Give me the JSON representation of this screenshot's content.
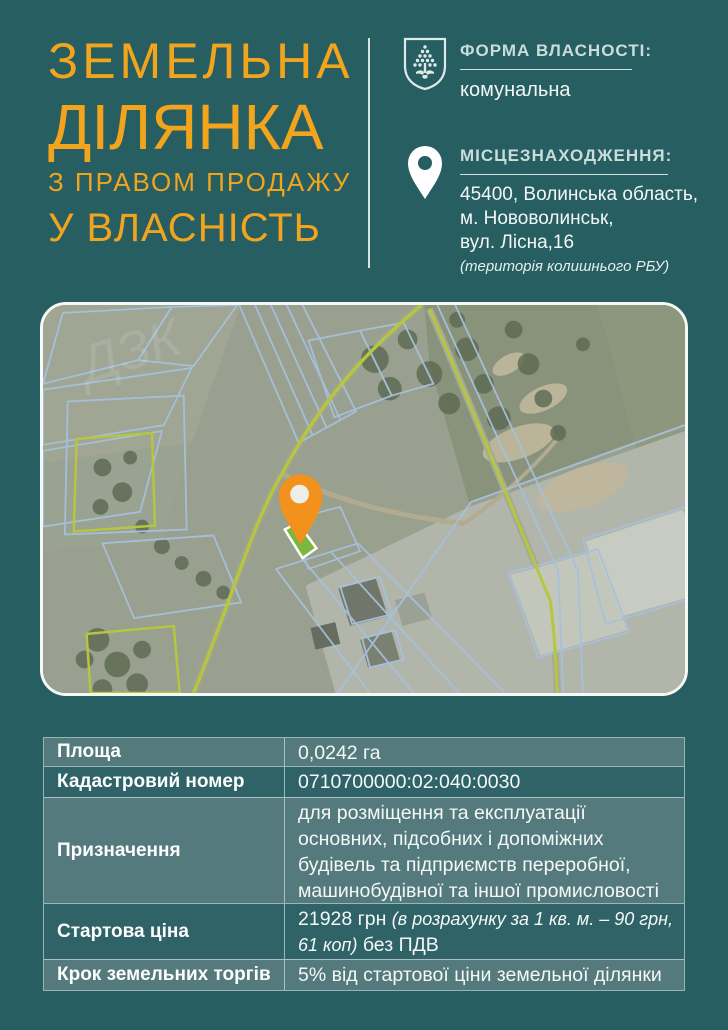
{
  "page": {
    "background_color": "#265e62",
    "accent_color": "#f2a41d"
  },
  "title": {
    "line1": "ЗЕМЕЛЬНА",
    "line2": "ДІЛЯНКА",
    "line3": "З ПРАВОМ ПРОДАЖУ",
    "line4": "У ВЛАСНІСТЬ"
  },
  "ownership": {
    "heading": "ФОРМА ВЛАСНОСТІ:",
    "value": "комунальна",
    "icon": "coat-of-arms-shield-fir-tree"
  },
  "location": {
    "heading": "МІСЦЕЗНАХОДЖЕННЯ:",
    "icon": "map-pin",
    "lines": [
      "45400, Волинська область,",
      "м. Нововолинськ,",
      "вул. Лісна,16"
    ],
    "note": "(територія колишнього РБУ)"
  },
  "map": {
    "watermark": "ДЗК",
    "pin_color": "#f2921c",
    "plot_highlight_color": "#7cb63f",
    "cadastral_line_color": "#a6c1dd",
    "road_line_color": "#b7c63e"
  },
  "table": {
    "rows": [
      {
        "label": "Площа",
        "value": [
          {
            "t": "0,0242 га"
          }
        ]
      },
      {
        "label": "Кадастровий номер",
        "value": [
          {
            "t": "0710700000:02:040:0030"
          }
        ]
      },
      {
        "label": "Призначення",
        "value": [
          {
            "t": "для розміщення та експлуатації основних, підсобних і допоміжних будівель та підприємств переробної, машинобудівної та іншої промисловості"
          }
        ]
      },
      {
        "label": "Стартова ціна",
        "value": [
          {
            "t": "21928 грн "
          },
          {
            "t": "(в розрахунку за 1 кв. м. – 90 грн, 61 коп)",
            "i": true
          },
          {
            "t": " без ПДВ"
          }
        ]
      },
      {
        "label": "Крок земельних торгів",
        "value": [
          {
            "t": "5% від стартової ціни земельної ділянки"
          }
        ]
      }
    ]
  }
}
